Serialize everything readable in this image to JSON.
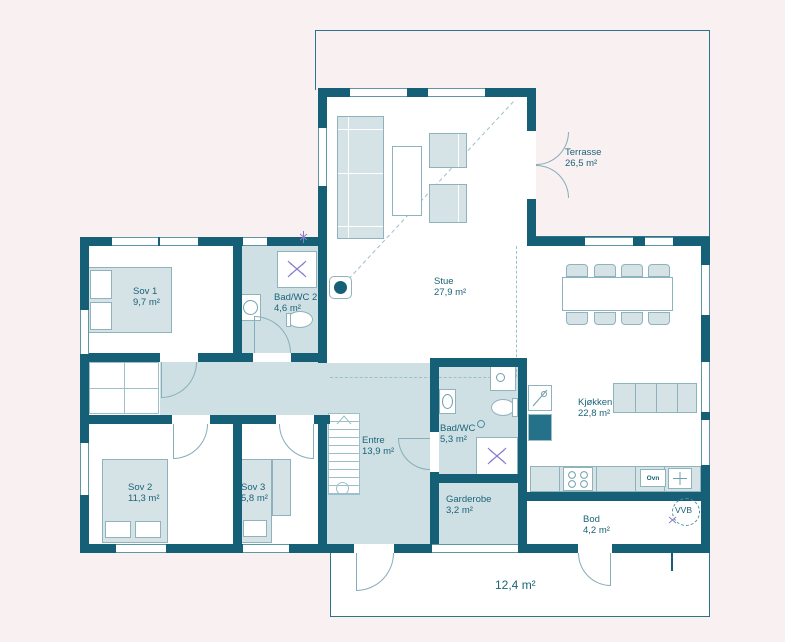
{
  "rooms": [
    {
      "id": "sov1",
      "name": "Sov 1",
      "area": "9,7 m²"
    },
    {
      "id": "bad_wc_2",
      "name": "Bad/WC 2",
      "area": "4,6 m²"
    },
    {
      "id": "stue",
      "name": "Stue",
      "area": "27,9 m²"
    },
    {
      "id": "terrasse",
      "name": "Terrasse",
      "area": "26,5 m²"
    },
    {
      "id": "kjokken",
      "name": "Kjøkken",
      "area": "22,8 m²"
    },
    {
      "id": "entre",
      "name": "Entre",
      "area": "13,9 m²"
    },
    {
      "id": "bad_wc",
      "name": "Bad/WC",
      "area": "5,3 m²"
    },
    {
      "id": "garderobe",
      "name": "Garderobe",
      "area": "3,2 m²"
    },
    {
      "id": "sov2",
      "name": "Sov 2",
      "area": "11,3 m²"
    },
    {
      "id": "sov3",
      "name": "Sov 3",
      "area": "5,8 m²"
    },
    {
      "id": "bod",
      "name": "Bod",
      "area": "4,2 m²"
    },
    {
      "id": "uteplass",
      "name": "",
      "area": "12,4 m²"
    }
  ],
  "labels": {
    "vvb": "VVB",
    "ovn": "Ovn"
  },
  "colors": {
    "wall": "#166077",
    "room_fill": "#cfe0e5",
    "background": "#f9f0f1",
    "text": "#1b6377",
    "shower_symbol": "#8a7ccc"
  }
}
